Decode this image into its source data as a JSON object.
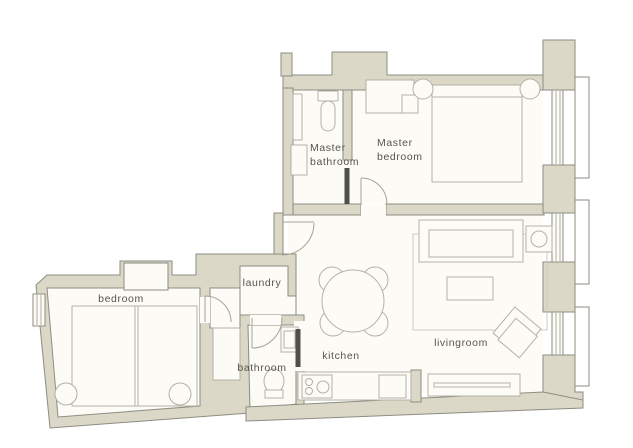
{
  "title": "Apartment floor plan",
  "rooms": {
    "master_bathroom": {
      "line1": "Master",
      "line2": "bathroom"
    },
    "master_bedroom": {
      "line1": "Master",
      "line2": "bedroom"
    },
    "bedroom": {
      "label": "bedroom"
    },
    "laundry": {
      "label": "laundry"
    },
    "bathroom": {
      "label": "bathroom"
    },
    "kitchen": {
      "label": "kitchen"
    },
    "livingroom": {
      "label": "livingroom"
    }
  },
  "colors": {
    "background": "#ffffff",
    "floor": "#fcfbf6",
    "wall_fill": "#dbd8c7",
    "wall_stroke": "#8d8c82",
    "furniture_stroke": "#b3b1a6",
    "rug_stroke": "#cdcbc1",
    "door_stroke": "#a5a399",
    "dark_door": "#4e4e4a",
    "balcony_stroke": "#8d8c82",
    "label": "#55544f"
  }
}
